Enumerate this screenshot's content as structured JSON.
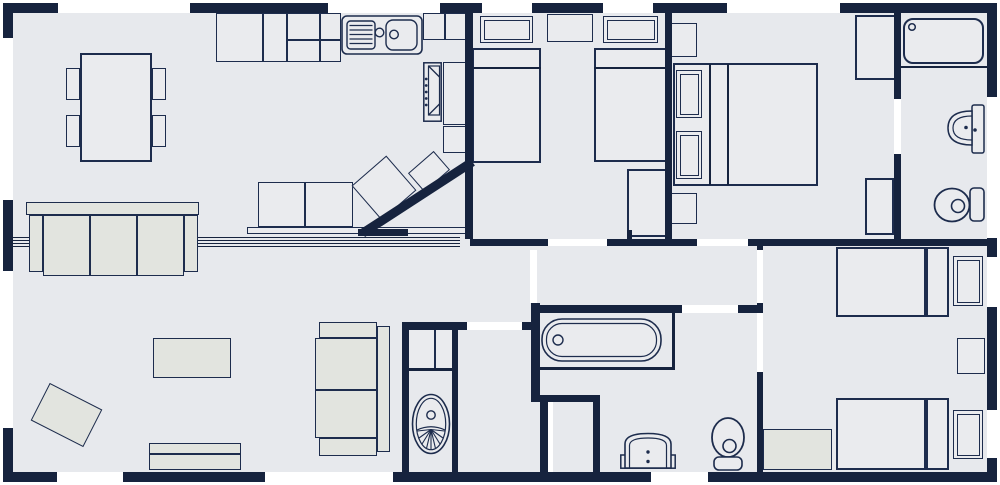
{
  "canvas": {
    "width": 1000,
    "height": 485
  },
  "colors": {
    "wall": "#16233e",
    "stroke": "#1d2c4d",
    "floor": "#e7e9ed",
    "furn": "#eaebee",
    "alt": "#e2e4df",
    "white": "#ffffff"
  },
  "floor": {
    "name": "floor-area",
    "x": 6,
    "y": 6,
    "w": 988,
    "h": 473
  },
  "elements": [
    {
      "n": "partition-track-line",
      "t": "line",
      "x": 13,
      "y": 237,
      "w": 447,
      "h": 1.2
    },
    {
      "n": "partition-track-line",
      "t": "line",
      "x": 13,
      "y": 240,
      "w": 447,
      "h": 1.2
    },
    {
      "n": "partition-track-line",
      "t": "line",
      "x": 13,
      "y": 243,
      "w": 447,
      "h": 1.2
    },
    {
      "n": "partition-track-line",
      "t": "line",
      "x": 13,
      "y": 245.5,
      "w": 447,
      "h": 1.2
    },
    {
      "n": "dining-table",
      "t": "rect",
      "x": 80,
      "y": 53,
      "w": 72,
      "h": 109,
      "sw": 2
    },
    {
      "n": "dining-chair",
      "t": "rect",
      "x": 66,
      "y": 68,
      "w": 14,
      "h": 32
    },
    {
      "n": "dining-chair",
      "t": "rect",
      "x": 66,
      "y": 115,
      "w": 14,
      "h": 32
    },
    {
      "n": "dining-chair",
      "t": "rect",
      "x": 152,
      "y": 68,
      "w": 14,
      "h": 32
    },
    {
      "n": "dining-chair",
      "t": "rect",
      "x": 152,
      "y": 115,
      "w": 14,
      "h": 32
    },
    {
      "n": "kitchen-unit",
      "t": "rect",
      "x": 216,
      "y": 13,
      "w": 47,
      "h": 49
    },
    {
      "n": "kitchen-unit",
      "t": "rect",
      "x": 263,
      "y": 13,
      "w": 24,
      "h": 49
    },
    {
      "n": "kitchen-unit",
      "t": "rect",
      "x": 287,
      "y": 13,
      "w": 33,
      "h": 27
    },
    {
      "n": "kitchen-unit",
      "t": "rect",
      "x": 320,
      "y": 13,
      "w": 21,
      "h": 27
    },
    {
      "n": "kitchen-unit",
      "t": "rect",
      "x": 287,
      "y": 40,
      "w": 33,
      "h": 22
    },
    {
      "n": "kitchen-unit",
      "t": "rect",
      "x": 320,
      "y": 40,
      "w": 21,
      "h": 22
    },
    {
      "n": "kitchen-unit",
      "t": "rect",
      "x": 423,
      "y": 13,
      "w": 22,
      "h": 27
    },
    {
      "n": "kitchen-unit",
      "t": "rect",
      "x": 445,
      "y": 13,
      "w": 22,
      "h": 27
    },
    {
      "n": "kitchen-unit",
      "t": "rect",
      "x": 443,
      "y": 62,
      "w": 24,
      "h": 63
    },
    {
      "n": "kitchen-unit",
      "t": "rect",
      "x": 443,
      "y": 126,
      "w": 24,
      "h": 27
    },
    {
      "n": "kitchen-sink",
      "t": "g:sink",
      "x": 341,
      "y": 15,
      "w": 82,
      "h": 40
    },
    {
      "n": "oven",
      "t": "g:oven",
      "x": 423,
      "y": 62,
      "w": 19,
      "h": 60
    },
    {
      "n": "peninsula-cabinet",
      "t": "rect",
      "x": 258,
      "y": 182,
      "w": 47,
      "h": 45
    },
    {
      "n": "peninsula-cabinet",
      "t": "rect",
      "x": 305,
      "y": 182,
      "w": 48,
      "h": 45
    },
    {
      "n": "breakfast-counter",
      "t": "rect",
      "x": 247,
      "y": 227,
      "w": 221,
      "h": 7,
      "sw": 1.2
    },
    {
      "n": "angled-kitchen-unit",
      "t": "rect",
      "x": 361,
      "y": 165,
      "w": 46,
      "h": 46,
      "r": -41
    },
    {
      "n": "angled-kitchen-unit",
      "t": "rect",
      "x": 412,
      "y": 159,
      "w": 34,
      "h": 25,
      "r": -41
    },
    {
      "n": "sofa-back",
      "t": "rect",
      "x": 26,
      "y": 202,
      "w": 173,
      "h": 13,
      "f": "alt",
      "sw": 1.2
    },
    {
      "n": "sofa-arm",
      "t": "rect",
      "x": 29,
      "y": 215,
      "w": 14,
      "h": 57,
      "f": "alt"
    },
    {
      "n": "sofa-arm",
      "t": "rect",
      "x": 184,
      "y": 215,
      "w": 14,
      "h": 57,
      "f": "alt"
    },
    {
      "n": "sofa-cushion",
      "t": "rect",
      "x": 43,
      "y": 215,
      "w": 47,
      "h": 61,
      "f": "alt"
    },
    {
      "n": "sofa-cushion",
      "t": "rect",
      "x": 90,
      "y": 215,
      "w": 47,
      "h": 61,
      "f": "alt"
    },
    {
      "n": "sofa-cushion",
      "t": "rect",
      "x": 137,
      "y": 215,
      "w": 47,
      "h": 61,
      "f": "alt"
    },
    {
      "n": "sofa-arm",
      "t": "rect",
      "x": 319,
      "y": 322,
      "w": 58,
      "h": 16,
      "f": "alt"
    },
    {
      "n": "sofa-arm",
      "t": "rect",
      "x": 319,
      "y": 438,
      "w": 58,
      "h": 18,
      "f": "alt"
    },
    {
      "n": "sofa-back",
      "t": "rect",
      "x": 377,
      "y": 326,
      "w": 13,
      "h": 126,
      "f": "alt"
    },
    {
      "n": "sofa-cushion",
      "t": "rect",
      "x": 315,
      "y": 338,
      "w": 62,
      "h": 52,
      "f": "alt"
    },
    {
      "n": "sofa-cushion",
      "t": "rect",
      "x": 315,
      "y": 390,
      "w": 62,
      "h": 48,
      "f": "alt"
    },
    {
      "n": "coffee-table",
      "t": "rect",
      "x": 153,
      "y": 338,
      "w": 78,
      "h": 40,
      "f": "alt"
    },
    {
      "n": "rug",
      "t": "rect",
      "x": 37,
      "y": 394,
      "w": 59,
      "h": 42,
      "r": 27,
      "f": "alt"
    },
    {
      "n": "tv-unit-shelf",
      "t": "rect",
      "x": 149,
      "y": 443,
      "w": 92,
      "h": 11,
      "f": "alt"
    },
    {
      "n": "tv-unit",
      "t": "rect",
      "x": 149,
      "y": 454,
      "w": 92,
      "h": 16,
      "f": "alt"
    },
    {
      "n": "bed-pillow",
      "t": "double",
      "x": 480,
      "y": 16,
      "w": 53,
      "h": 27
    },
    {
      "n": "bed-pillow",
      "t": "double",
      "x": 603,
      "y": 16,
      "w": 55,
      "h": 27
    },
    {
      "n": "bedside-table",
      "t": "rect",
      "x": 547,
      "y": 14,
      "w": 46,
      "h": 28
    },
    {
      "n": "single-bed",
      "t": "rect",
      "x": 472,
      "y": 48,
      "w": 69,
      "h": 115,
      "sw": 2
    },
    {
      "n": "single-bed",
      "t": "rect",
      "x": 594,
      "y": 48,
      "w": 73,
      "h": 114,
      "sw": 2
    },
    {
      "n": "bed-headboard-line",
      "t": "line",
      "x": 472,
      "y": 67,
      "w": 69,
      "h": 1.5
    },
    {
      "n": "bed-headboard-line",
      "t": "line",
      "x": 594,
      "y": 67,
      "w": 73,
      "h": 1.5
    },
    {
      "n": "wardrobe",
      "t": "rect",
      "x": 627,
      "y": 169,
      "w": 40,
      "h": 68,
      "sw": 2
    },
    {
      "n": "double-bed",
      "t": "rect",
      "x": 673,
      "y": 63,
      "w": 145,
      "h": 123,
      "sw": 2
    },
    {
      "n": "bed-headboard-line",
      "t": "line",
      "x": 709,
      "y": 64,
      "w": 1.5,
      "h": 121
    },
    {
      "n": "bed-headboard-line",
      "t": "line",
      "x": 727,
      "y": 64,
      "w": 1.5,
      "h": 121
    },
    {
      "n": "bed-pillow",
      "t": "double",
      "x": 676,
      "y": 70,
      "w": 26,
      "h": 48
    },
    {
      "n": "bed-pillow",
      "t": "double",
      "x": 676,
      "y": 131,
      "w": 26,
      "h": 48
    },
    {
      "n": "bedside-table",
      "t": "rect",
      "x": 671,
      "y": 23,
      "w": 26,
      "h": 34
    },
    {
      "n": "bedside-table",
      "t": "rect",
      "x": 671,
      "y": 193,
      "w": 26,
      "h": 31
    },
    {
      "n": "wardrobe",
      "t": "rect",
      "x": 855,
      "y": 15,
      "w": 42,
      "h": 65,
      "sw": 2
    },
    {
      "n": "wardrobe",
      "t": "rect",
      "x": 865,
      "y": 178,
      "w": 29,
      "h": 57,
      "sw": 2
    },
    {
      "n": "shower-tray",
      "t": "g:shower",
      "x": 903,
      "y": 18,
      "w": 81,
      "h": 46
    },
    {
      "n": "ensuite-divider-line",
      "t": "line",
      "x": 898,
      "y": 66,
      "w": 89,
      "h": 2
    },
    {
      "n": "washbasin",
      "t": "g:ebasin",
      "x": 947,
      "y": 104,
      "w": 38,
      "h": 50
    },
    {
      "n": "toilet",
      "t": "g:etoilet",
      "x": 933,
      "y": 186,
      "w": 52,
      "h": 38
    },
    {
      "n": "bathtub",
      "t": "g:bath",
      "x": 541,
      "y": 318,
      "w": 121,
      "h": 44
    },
    {
      "n": "bath-alcove-line",
      "t": "line",
      "x": 533,
      "y": 367,
      "w": 142,
      "h": 2.5
    },
    {
      "n": "bath-alcove-line",
      "t": "line",
      "x": 672,
      "y": 313,
      "w": 2.5,
      "h": 56
    },
    {
      "n": "vanity-unit",
      "t": "g:vanity",
      "x": 620,
      "y": 431,
      "w": 56,
      "h": 38
    },
    {
      "n": "toilet",
      "t": "g:toilet2",
      "x": 710,
      "y": 416,
      "w": 36,
      "h": 55
    },
    {
      "n": "utility-cabinet",
      "t": "rect",
      "x": 408,
      "y": 329,
      "w": 27,
      "h": 40
    },
    {
      "n": "utility-cabinet",
      "t": "rect",
      "x": 435,
      "y": 329,
      "w": 18,
      "h": 40
    },
    {
      "n": "utility-divider-line",
      "t": "line",
      "x": 408,
      "y": 368,
      "w": 50,
      "h": 3
    },
    {
      "n": "utility-basin",
      "t": "g:ubasin",
      "x": 411,
      "y": 393,
      "w": 40,
      "h": 63
    },
    {
      "n": "single-bed",
      "t": "rect",
      "x": 836,
      "y": 247,
      "w": 90,
      "h": 70,
      "sw": 2
    },
    {
      "n": "bed-headboard",
      "t": "rect",
      "x": 926,
      "y": 247,
      "w": 23,
      "h": 70,
      "sw": 2
    },
    {
      "n": "bed-pillow",
      "t": "double",
      "x": 953,
      "y": 256,
      "w": 30,
      "h": 50
    },
    {
      "n": "single-bed",
      "t": "rect",
      "x": 836,
      "y": 398,
      "w": 90,
      "h": 72,
      "sw": 2
    },
    {
      "n": "bed-headboard",
      "t": "rect",
      "x": 926,
      "y": 398,
      "w": 23,
      "h": 72,
      "sw": 2
    },
    {
      "n": "bed-pillow",
      "t": "double",
      "x": 953,
      "y": 410,
      "w": 30,
      "h": 49
    },
    {
      "n": "bedside-table",
      "t": "rect",
      "x": 957,
      "y": 338,
      "w": 28,
      "h": 36
    },
    {
      "n": "bedroom-cabinet",
      "t": "rect",
      "x": 763,
      "y": 429,
      "w": 69,
      "h": 41,
      "f": "alt"
    },
    {
      "n": "exterior-wall-top",
      "t": "wall",
      "x": 3,
      "y": 3,
      "w": 994,
      "h": 10
    },
    {
      "n": "exterior-wall-bottom",
      "t": "wall",
      "x": 3,
      "y": 472,
      "w": 994,
      "h": 10
    },
    {
      "n": "exterior-wall-left",
      "t": "wall",
      "x": 3,
      "y": 3,
      "w": 10,
      "h": 479
    },
    {
      "n": "exterior-wall-right",
      "t": "wall",
      "x": 987,
      "y": 3,
      "w": 10,
      "h": 479
    },
    {
      "n": "kitchen-bedroom-wall",
      "t": "wall",
      "x": 465,
      "y": 13,
      "w": 8,
      "h": 226
    },
    {
      "n": "bedroom-divider-wall",
      "t": "wall",
      "x": 665,
      "y": 13,
      "w": 7,
      "h": 233
    },
    {
      "n": "ensuite-wall",
      "t": "wall",
      "x": 894,
      "y": 13,
      "w": 7,
      "h": 233
    },
    {
      "n": "central-divider-wall",
      "t": "wall",
      "x": 470,
      "y": 239,
      "w": 517,
      "h": 7
    },
    {
      "n": "kitchen-diagonal-wall",
      "t": "wall",
      "x": 352,
      "y": 193,
      "w": 131,
      "h": 9,
      "r": -33
    },
    {
      "n": "wall-stub",
      "t": "wall",
      "x": 358,
      "y": 229,
      "w": 50,
      "h": 7
    },
    {
      "n": "bathroom-side-wall",
      "t": "wall",
      "x": 531,
      "y": 303,
      "w": 9,
      "h": 97
    },
    {
      "n": "bathroom-top-wall",
      "t": "wall",
      "x": 535,
      "y": 305,
      "w": 147,
      "h": 8
    },
    {
      "n": "bathroom-top-wall",
      "t": "wall",
      "x": 738,
      "y": 305,
      "w": 24,
      "h": 8
    },
    {
      "n": "rear-bedroom-wall",
      "t": "wall",
      "x": 757,
      "y": 246,
      "w": 6,
      "h": 4
    },
    {
      "n": "rear-bedroom-wall",
      "t": "wall",
      "x": 757,
      "y": 303,
      "w": 6,
      "h": 10
    },
    {
      "n": "rear-bedroom-wall",
      "t": "wall",
      "x": 757,
      "y": 372,
      "w": 6,
      "h": 100
    },
    {
      "n": "utility-wall",
      "t": "wall",
      "x": 402,
      "y": 322,
      "w": 7,
      "h": 151
    },
    {
      "n": "utility-wall",
      "t": "wall",
      "x": 402,
      "y": 322,
      "w": 65,
      "h": 8
    },
    {
      "n": "utility-wall",
      "t": "wall",
      "x": 452,
      "y": 330,
      "w": 6,
      "h": 143
    },
    {
      "n": "utility-wall",
      "t": "wall",
      "x": 522,
      "y": 322,
      "w": 12,
      "h": 8
    },
    {
      "n": "cupboard-wall",
      "t": "wall",
      "x": 531,
      "y": 395,
      "w": 69,
      "h": 7
    },
    {
      "n": "cupboard-wall",
      "t": "wall",
      "x": 593,
      "y": 395,
      "w": 7,
      "h": 77
    },
    {
      "n": "cupboard-wall",
      "t": "wall",
      "x": 540,
      "y": 402,
      "w": 8,
      "h": 70
    },
    {
      "n": "wardrobe-wall-stub",
      "t": "wall",
      "x": 627,
      "y": 230,
      "w": 5,
      "h": 9
    },
    {
      "n": "window-opening",
      "t": "white",
      "x": 58,
      "y": 3,
      "w": 132,
      "h": 10
    },
    {
      "n": "window-opening",
      "t": "white",
      "x": 328,
      "y": 3,
      "w": 112,
      "h": 10
    },
    {
      "n": "window-opening",
      "t": "white",
      "x": 482,
      "y": 3,
      "w": 50,
      "h": 10
    },
    {
      "n": "window-opening",
      "t": "white",
      "x": 603,
      "y": 3,
      "w": 50,
      "h": 10
    },
    {
      "n": "window-opening",
      "t": "white",
      "x": 727,
      "y": 3,
      "w": 113,
      "h": 10
    },
    {
      "n": "door-opening",
      "t": "white",
      "x": 57,
      "y": 472,
      "w": 66,
      "h": 10
    },
    {
      "n": "patio-door-opening",
      "t": "white",
      "x": 265,
      "y": 472,
      "w": 128,
      "h": 10
    },
    {
      "n": "window-opening",
      "t": "white",
      "x": 651,
      "y": 472,
      "w": 57,
      "h": 10
    },
    {
      "n": "window-opening",
      "t": "white",
      "x": 3,
      "y": 38,
      "w": 10,
      "h": 162
    },
    {
      "n": "window-opening",
      "t": "white",
      "x": 3,
      "y": 271,
      "w": 10,
      "h": 157
    },
    {
      "n": "window-opening",
      "t": "white",
      "x": 987,
      "y": 97,
      "w": 10,
      "h": 141
    },
    {
      "n": "window-opening",
      "t": "white",
      "x": 987,
      "y": 257,
      "w": 10,
      "h": 50
    },
    {
      "n": "window-opening",
      "t": "white",
      "x": 987,
      "y": 410,
      "w": 10,
      "h": 48
    },
    {
      "n": "ensuite-door-opening",
      "t": "white",
      "x": 894,
      "y": 99,
      "w": 7,
      "h": 55
    },
    {
      "n": "twin-bedroom-door-opening",
      "t": "white",
      "x": 548,
      "y": 239,
      "w": 59,
      "h": 7
    },
    {
      "n": "master-bedroom-door-opening",
      "t": "white",
      "x": 697,
      "y": 239,
      "w": 51,
      "h": 7
    },
    {
      "n": "hallway-door-opening",
      "t": "white",
      "x": 530,
      "y": 250,
      "w": 7,
      "h": 53
    },
    {
      "n": "bathroom-door-opening",
      "t": "white",
      "x": 682,
      "y": 305,
      "w": 56,
      "h": 8
    },
    {
      "n": "rear-bedroom-door-opening",
      "t": "white",
      "x": 757,
      "y": 250,
      "w": 6,
      "h": 53
    },
    {
      "n": "rear-bedroom-door-opening",
      "t": "white",
      "x": 757,
      "y": 313,
      "w": 6,
      "h": 59
    },
    {
      "n": "vestibule-door-opening",
      "t": "white",
      "x": 467,
      "y": 322,
      "w": 55,
      "h": 8
    },
    {
      "n": "cupboard-door-opening",
      "t": "white",
      "x": 548,
      "y": 402,
      "w": 5,
      "h": 70
    }
  ]
}
